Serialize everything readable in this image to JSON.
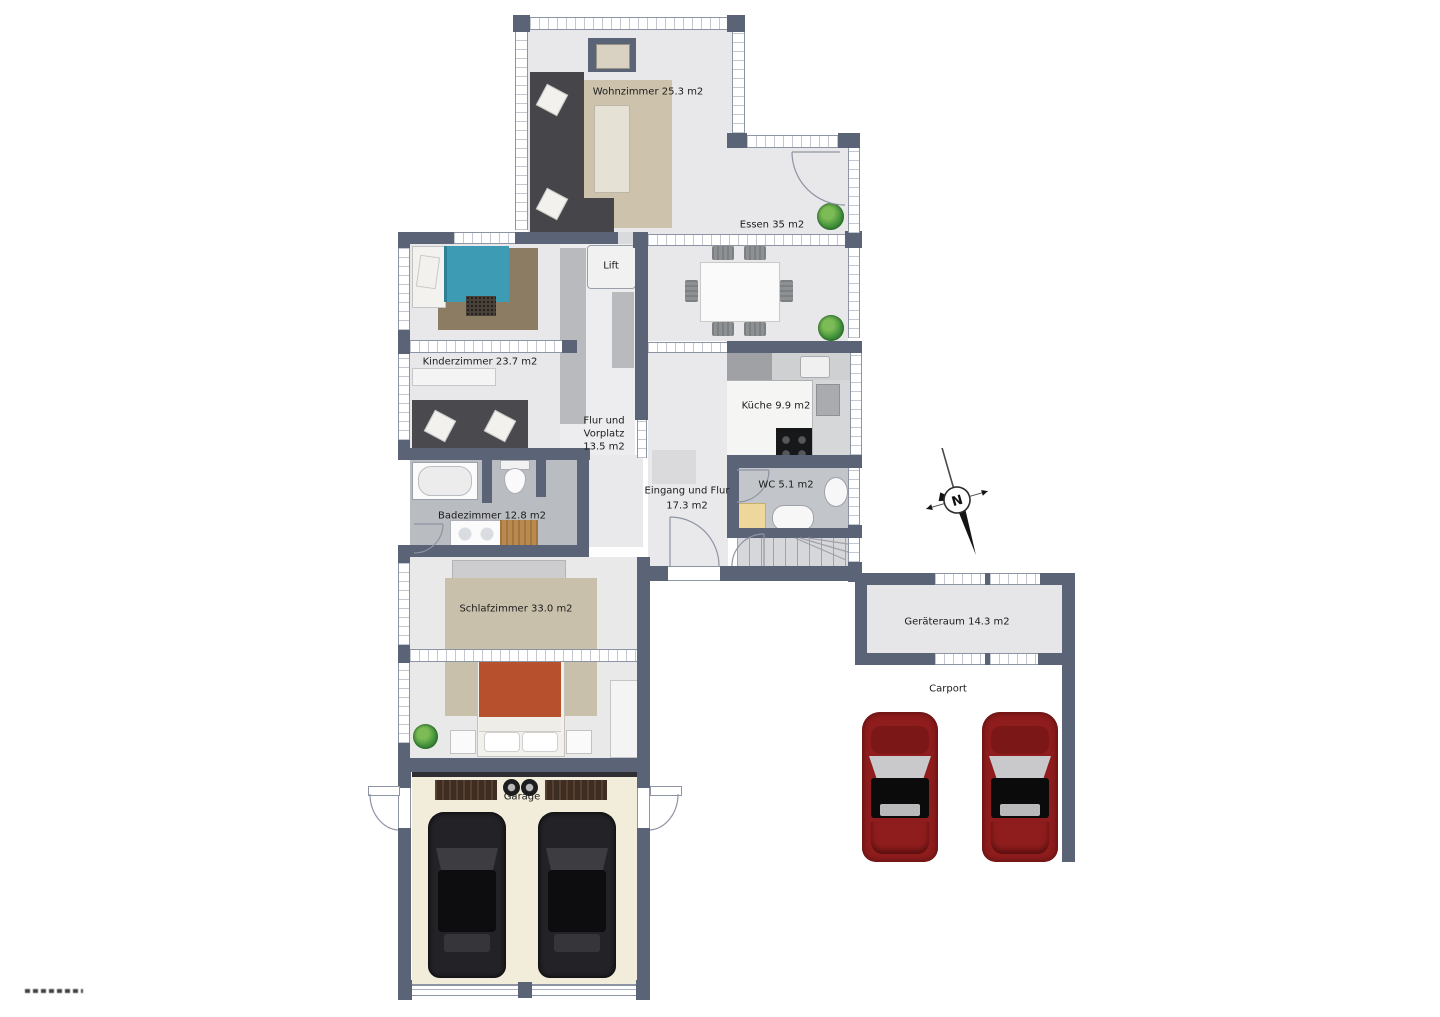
{
  "rooms": {
    "wohnzimmer": {
      "label": "Wohnzimmer 25.3 m2"
    },
    "essen": {
      "label": "Essen 35 m2"
    },
    "kinderzimmer": {
      "label": "Kinderzimmer 23.7 m2"
    },
    "lift": {
      "label": "Lift"
    },
    "flur_vorplatz": {
      "line1": "Flur und",
      "line2": "Vorplatz",
      "line3": "13.5 m2"
    },
    "kueche": {
      "label": "Küche 9.9 m2"
    },
    "eingang": {
      "line1": "Eingang und Flur",
      "line2": "17.3 m2"
    },
    "wc": {
      "label": "WC 5.1 m2"
    },
    "badezimmer": {
      "label": "Badezimmer 12.8 m2"
    },
    "schlafzimmer": {
      "label": "Schlafzimmer 33.0 m2"
    },
    "geraeteraum": {
      "label": "Geräteraum 14.3 m2"
    },
    "carport": {
      "label": "Carport"
    },
    "garage": {
      "label": "Garage"
    }
  },
  "compass": {
    "label": "N"
  },
  "colors": {
    "wall": "#5b6377",
    "floor": "#e8e8ea",
    "bath_tile": "#bcbfc4",
    "garage_floor": "#f2ecda",
    "car_red": "#8f1d1d",
    "car_black": "#232326",
    "bed_teal": "#3d9cb4",
    "bed_orange": "#b7512d",
    "plant_green": "#3f8f3a"
  }
}
